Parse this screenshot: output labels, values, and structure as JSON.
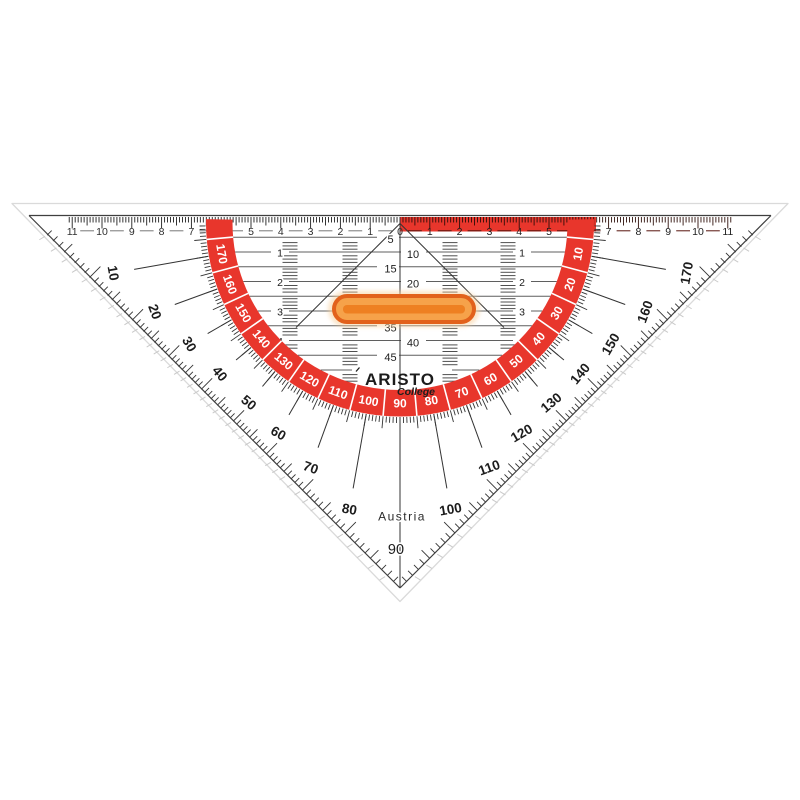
{
  "product": {
    "kind": "protractor-set-square",
    "brand": "ARISTO",
    "line": "College",
    "origin": "Austria"
  },
  "colors": {
    "red": "#e8362c",
    "band_number": "#ffffff",
    "ink": "#1c1c1c",
    "ruler_ink": "#2e2e2e",
    "grid_line": "#5f5f5f",
    "tick": "#333333",
    "hatch": "#4f4f4f",
    "dash_white_side": "#777777",
    "dash_red_side": "#57130c",
    "strip_tick": "#2e0f0a",
    "bevel": "#dadada",
    "leg_outer_dash": "#c9c9c9",
    "edge_line": "#3f3f3f",
    "handle_border": "#e2611b",
    "handle_fill": "#f6a24a",
    "handle_core": "#ed7c1e",
    "handle_halo": "#f8d2a0"
  },
  "ruler": {
    "left_numbers": [
      11,
      10,
      9,
      8,
      7,
      6,
      5,
      4,
      3,
      2,
      1
    ],
    "zero": "0",
    "right_numbers": [
      1,
      2,
      3,
      4,
      5,
      6,
      7,
      8,
      9,
      10,
      11
    ]
  },
  "protractor": {
    "band_numbers": [
      10,
      20,
      30,
      40,
      50,
      60,
      70,
      80,
      90,
      100,
      110,
      120,
      130,
      140,
      150,
      160,
      170
    ],
    "outer_numbers": [
      10,
      20,
      30,
      40,
      50,
      60,
      70,
      80,
      90,
      100,
      110,
      120,
      130,
      140,
      150,
      160,
      170
    ],
    "tip_number": "90"
  },
  "grid": {
    "mm_labels": [
      5,
      10,
      15,
      20,
      35,
      40,
      45
    ],
    "cm_row_labels": [
      1,
      2,
      3,
      4
    ]
  },
  "brand": {
    "name": "ARISTO",
    "line": "College",
    "origin": "Austria"
  }
}
